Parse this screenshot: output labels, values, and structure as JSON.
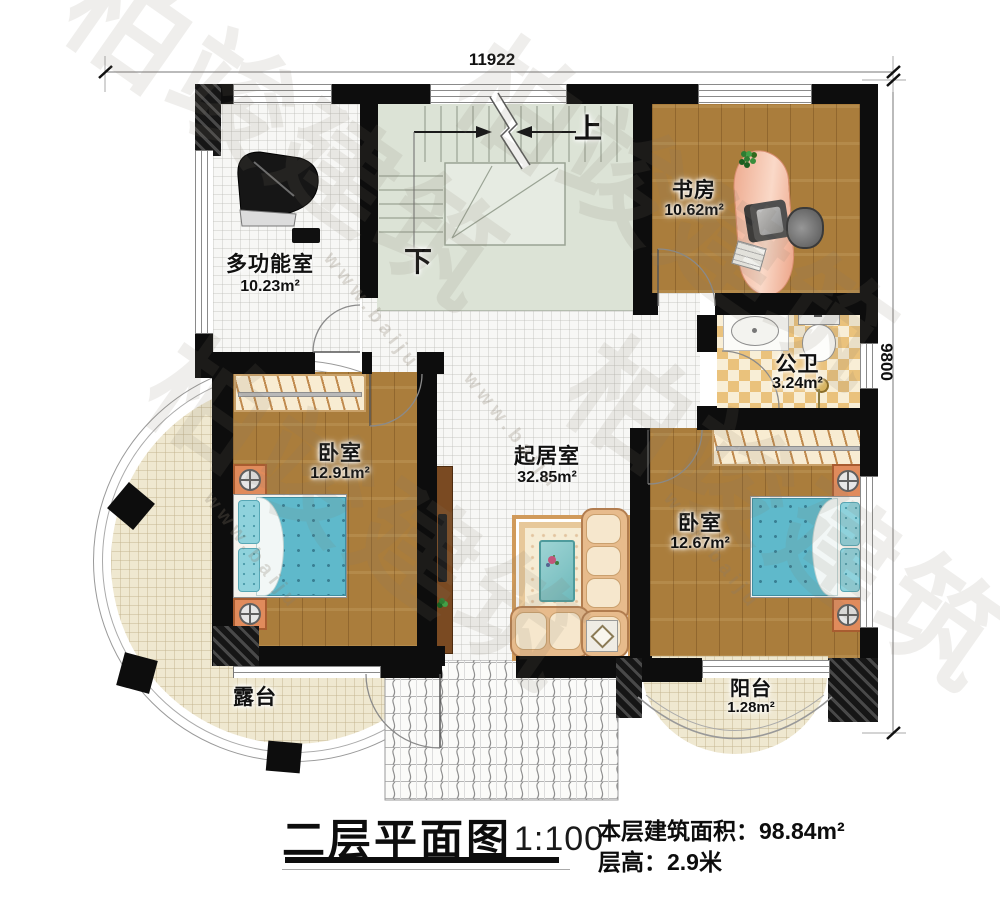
{
  "dimensions": {
    "top_width": "11922",
    "right_height": "9800"
  },
  "stairs": {
    "up_label": "上",
    "down_label": "下"
  },
  "rooms": {
    "multi": {
      "name": "多功能室",
      "area": "10.23m²"
    },
    "study": {
      "name": "书房",
      "area": "10.62m²"
    },
    "bathroom": {
      "name": "公卫",
      "area": "3.24m²"
    },
    "bedroom_left": {
      "name": "卧室",
      "area": "12.91m²"
    },
    "living": {
      "name": "起居室",
      "area": "32.85m²"
    },
    "bedroom_right": {
      "name": "卧室",
      "area": "12.67m²"
    },
    "terrace": {
      "name": "露台"
    },
    "balcony": {
      "name": "阳台",
      "area": "1.28m²"
    }
  },
  "title_block": {
    "title": "二层平面图",
    "scale": "1:100",
    "floor_area_label": "本层建筑面积：",
    "floor_area_value": "98.84m²",
    "floor_height_label": "层高：",
    "floor_height_value": "2.9米"
  },
  "watermark": {
    "brand": "柏竣建筑",
    "url": "www.baiju"
  },
  "colors": {
    "wall": "#0d0d0d",
    "wood": "#aa7d3c",
    "stair_floor": "#dce3d6",
    "bed": "#5fb9cb",
    "tile": "#eac27c",
    "terrace": "#efe8d0",
    "desk": "#f0b49c",
    "sofa": "#e7bb8c"
  }
}
